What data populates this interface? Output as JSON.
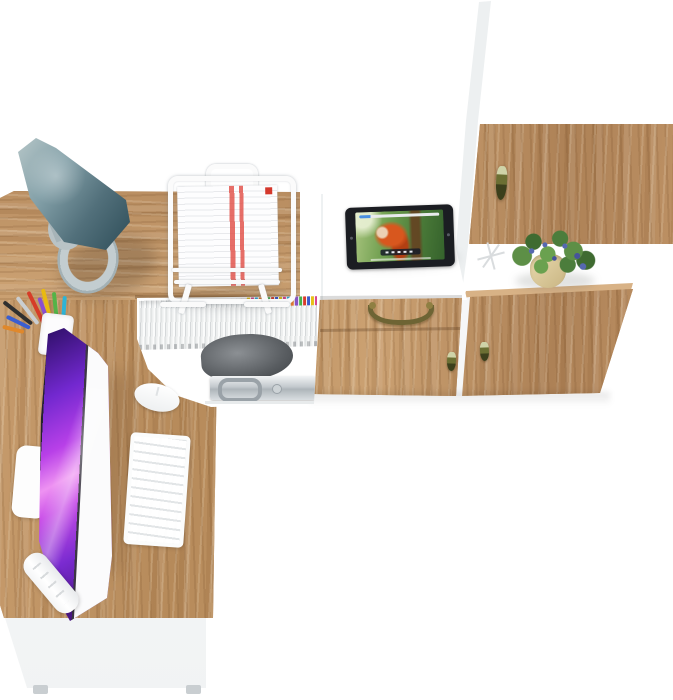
{
  "scene": {
    "title": "Bird's-eye view render of a home office set: L-shaped oak corner desk with white storage wall unit",
    "background": "#ffffff"
  },
  "palette": {
    "oak_wood": "#bf9263",
    "oak_wood_dark": "#a67c50",
    "oak_wood_light": "#d8b286",
    "furniture_white": "#ffffff",
    "lamp_teal": "#52707b",
    "lamp_base_gray": "#b9c3c6",
    "screen_purple": "#b840e8",
    "screen_violet": "#47157f",
    "plant_green": "#4c7d3c",
    "berry_blue": "#5668b0",
    "pot_beige": "#d9c89a",
    "handle_olive": "#6b6f33",
    "handle_brass": "#8f7f42",
    "briefcase_silver": "#c3c9cd",
    "shadow": "rgba(0,0,0,0.12)"
  },
  "objects": {
    "desk": {
      "name": "L-shaped corner desk with oak worktop"
    },
    "hutch_shelf": {
      "name": "Oak hutch shelf along the back of the desk"
    },
    "front_panel": {
      "name": "White desk front panel with feet"
    },
    "under_desk_shelf": {
      "name": "Under-desk storage niche"
    },
    "books": {
      "name": "Row of slim white binders with colored index tabs"
    },
    "gray_bag": {
      "name": "Gray pouch on shelf"
    },
    "briefcase": {
      "name": "Aluminium briefcase with handle and latch"
    },
    "desk_lamp": {
      "name": "Teal cone desk lamp with gray ring base"
    },
    "document_tray": {
      "name": "White wire document stand holding red-striped papers"
    },
    "pencil_cup": {
      "name": "White pencil cup with colored pens"
    },
    "monitor": {
      "name": "White all-in-one monitor showing purple abstract wallpaper"
    },
    "monitor_stand": {
      "name": "Monitor stand foot"
    },
    "keyboard": {
      "name": "White wireless keyboard"
    },
    "mouse": {
      "name": "White mouse"
    },
    "media_cabinet": {
      "name": "White cabinet with oak drawer and door fronts"
    },
    "drawer_bail_handle": {
      "name": "Brass bail handle"
    },
    "door_knob_a": {
      "name": "Olive teardrop knob"
    },
    "door_knob_b": {
      "name": "Olive teardrop knob"
    },
    "tall_cabinet": {
      "name": "Tall white wardrobe with oak door"
    },
    "upper_door_handle": {
      "name": "Olive pendant handle"
    },
    "open_shelf": {
      "name": "Open display shelf"
    },
    "potted_plant": {
      "name": "Potted plant with blue berries in beige pot"
    },
    "twig_decor": {
      "name": "White twig ornament"
    },
    "tablet": {
      "name": "Black tablet playing an animated movie"
    },
    "video": {
      "description": "Red-haired animated character in a green forest",
      "progress_color": "#4a90e2"
    }
  }
}
